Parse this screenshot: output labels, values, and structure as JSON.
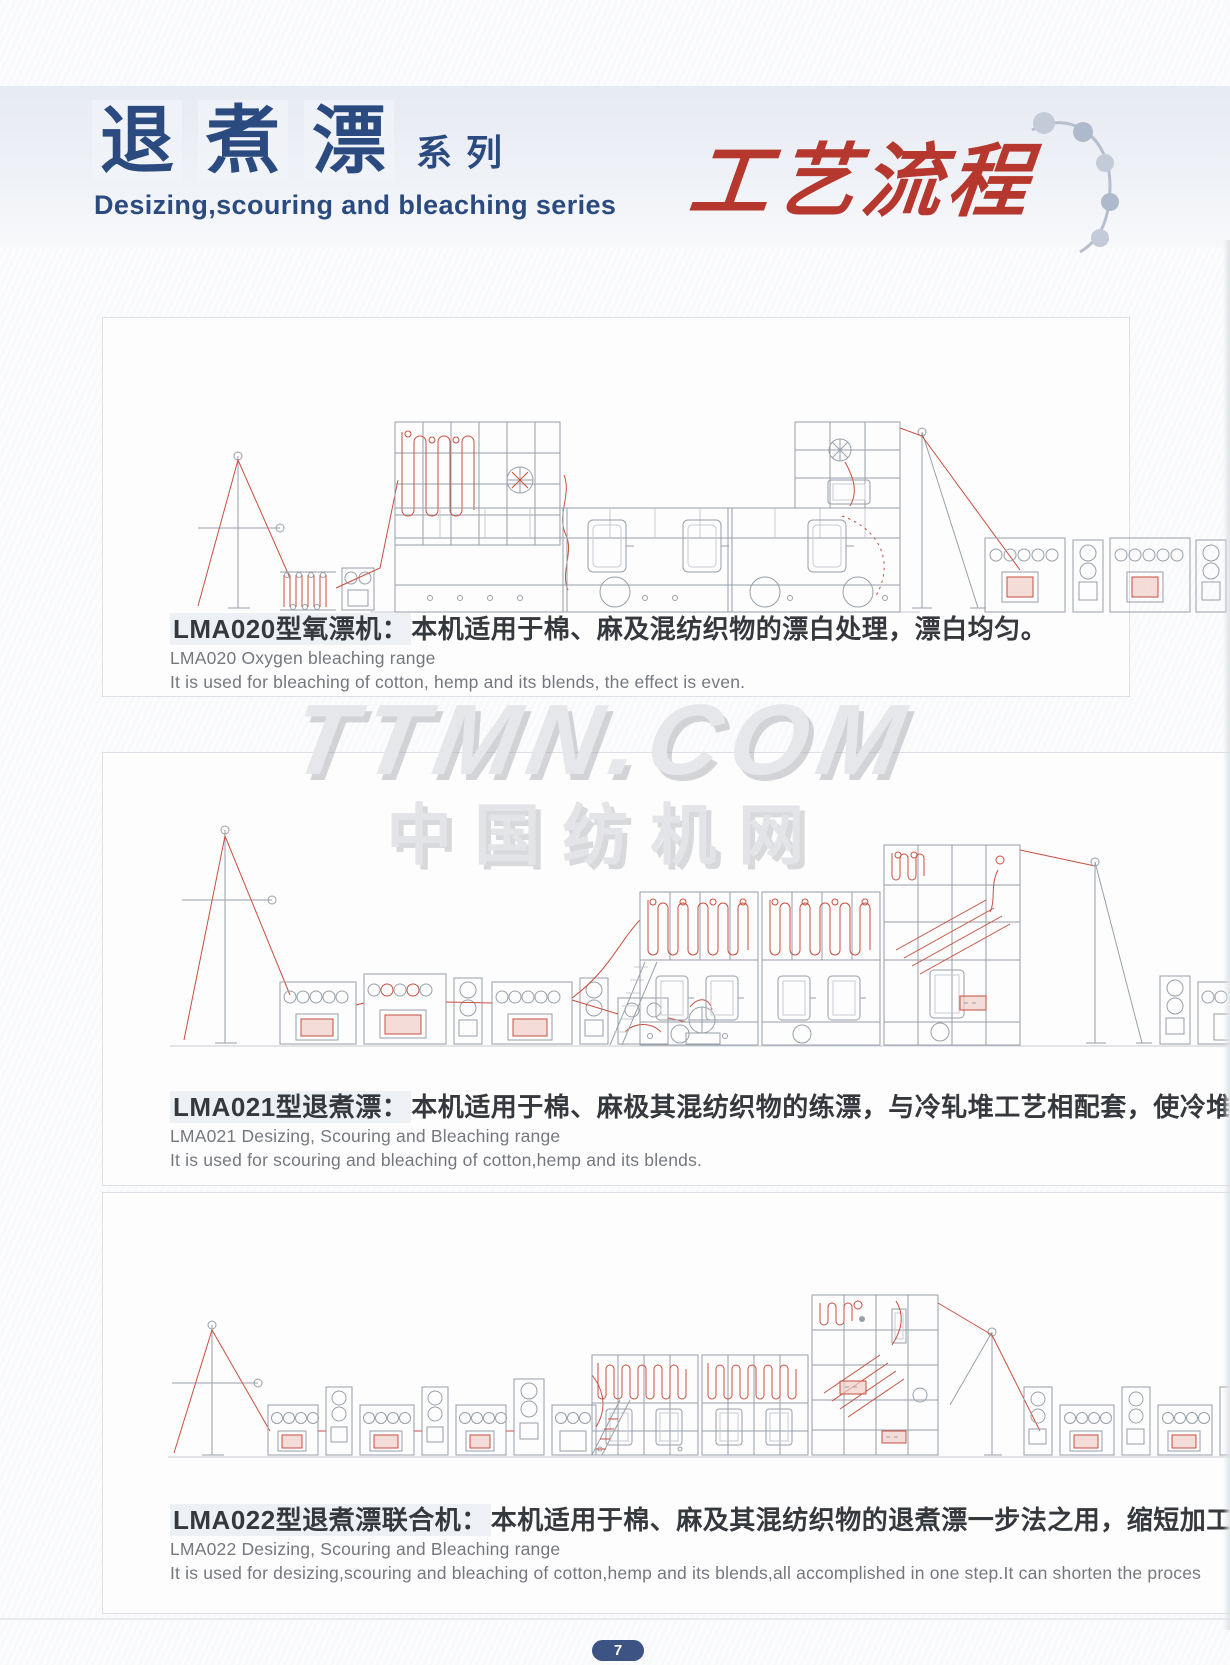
{
  "header": {
    "title_cn_chars": [
      "退",
      "煮",
      "漂"
    ],
    "title_suffix": "系列",
    "title_en": "Desizing,scouring and bleaching series",
    "process_title": "工艺流程"
  },
  "watermark": {
    "line1": "TTMN.COM",
    "line2": "中国纺机网"
  },
  "sections": [
    {
      "model": "LMA020",
      "caption_cn_model": "LMA020型氧漂机：",
      "caption_cn_rest": "本机适用于棉、麻及混纺织物的漂白处理，漂白均匀。",
      "caption_en_model": "LMA020 Oxygen bleaching range",
      "caption_en_desc": "It is used for bleaching of cotton, hemp and its blends, the effect is even."
    },
    {
      "model": "LMA021",
      "caption_cn_model": "LMA021型退煮漂：",
      "caption_cn_rest": "本机适用于棉、麻极其混纺织物的练漂，与冷轧堆工艺相配套，使冷堆",
      "caption_en_model": "LMA021 Desizing, Scouring and Bleaching range",
      "caption_en_desc": "It is used for scouring and bleaching of cotton,hemp and its blends."
    },
    {
      "model": "LMA022",
      "caption_cn_model": "LMA022型退煮漂联合机：",
      "caption_cn_rest": "本机适用于棉、麻及其混纺织物的退煮漂一步法之用，缩短加工",
      "caption_en_model": "LMA022 Desizing, Scouring and Bleaching range",
      "caption_en_desc": "It is used for desizing,scouring and bleaching of cotton,hemp and its blends,all accomplished in one step.It can shorten the proces"
    }
  ],
  "footer": {
    "page_number": "7"
  },
  "colors": {
    "title_navy": "#2b4a80",
    "process_red": "#b5372e",
    "caption_dark": "#35383d",
    "caption_gray": "#74787e",
    "machine_line": "#98a0a9",
    "fabric_red": "#c6503e",
    "watermark_gray": "#e6e7ea",
    "page_pill_navy": "#3d5384"
  }
}
